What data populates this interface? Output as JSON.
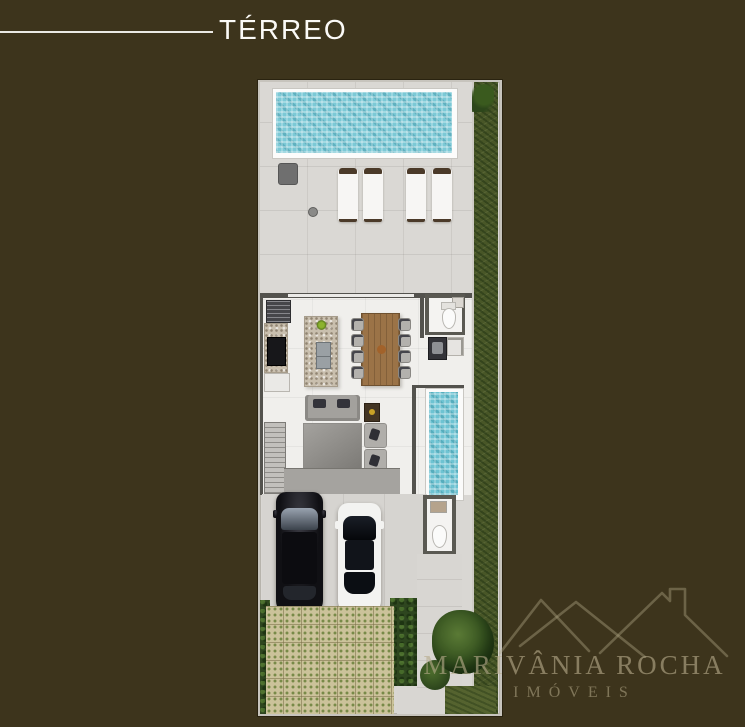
{
  "page": {
    "background_color": "#3d341c",
    "width": 745,
    "height": 727
  },
  "header": {
    "title": "TÉRREO"
  },
  "watermark": {
    "brand": "MARIVÂNIA ROCHA",
    "tagline": "IMÓVEIS",
    "logo_icon": "house-rooflines-icon",
    "color": "#8a7f61"
  },
  "plan": {
    "colors": {
      "pool_water": "#7cc9d6",
      "deck": "#dad8d4",
      "house_floor": "#f0efec",
      "wall": "#53524d",
      "grass": "#485627",
      "hedge": "#2e461f",
      "paver": "#cbc29a",
      "wood_table": "#9b7347",
      "granite_counter": "#c9bfae",
      "car_black": "#121216",
      "car_white": "#f3f3f1"
    },
    "features": [
      "swimming-pool",
      "pool-deck",
      "sun-umbrella",
      "lounge-chairs",
      "side-garden-strip",
      "kitchen",
      "refrigerator",
      "cooktop",
      "kitchen-island",
      "dining-table",
      "powder-room",
      "laundry-area",
      "lap-pool",
      "living-room",
      "sofa",
      "armchairs",
      "staircase",
      "garage",
      "black-car",
      "white-car",
      "garage-bathroom",
      "driveway-pavers",
      "hedges",
      "walkway",
      "rear-garden",
      "tree"
    ]
  }
}
